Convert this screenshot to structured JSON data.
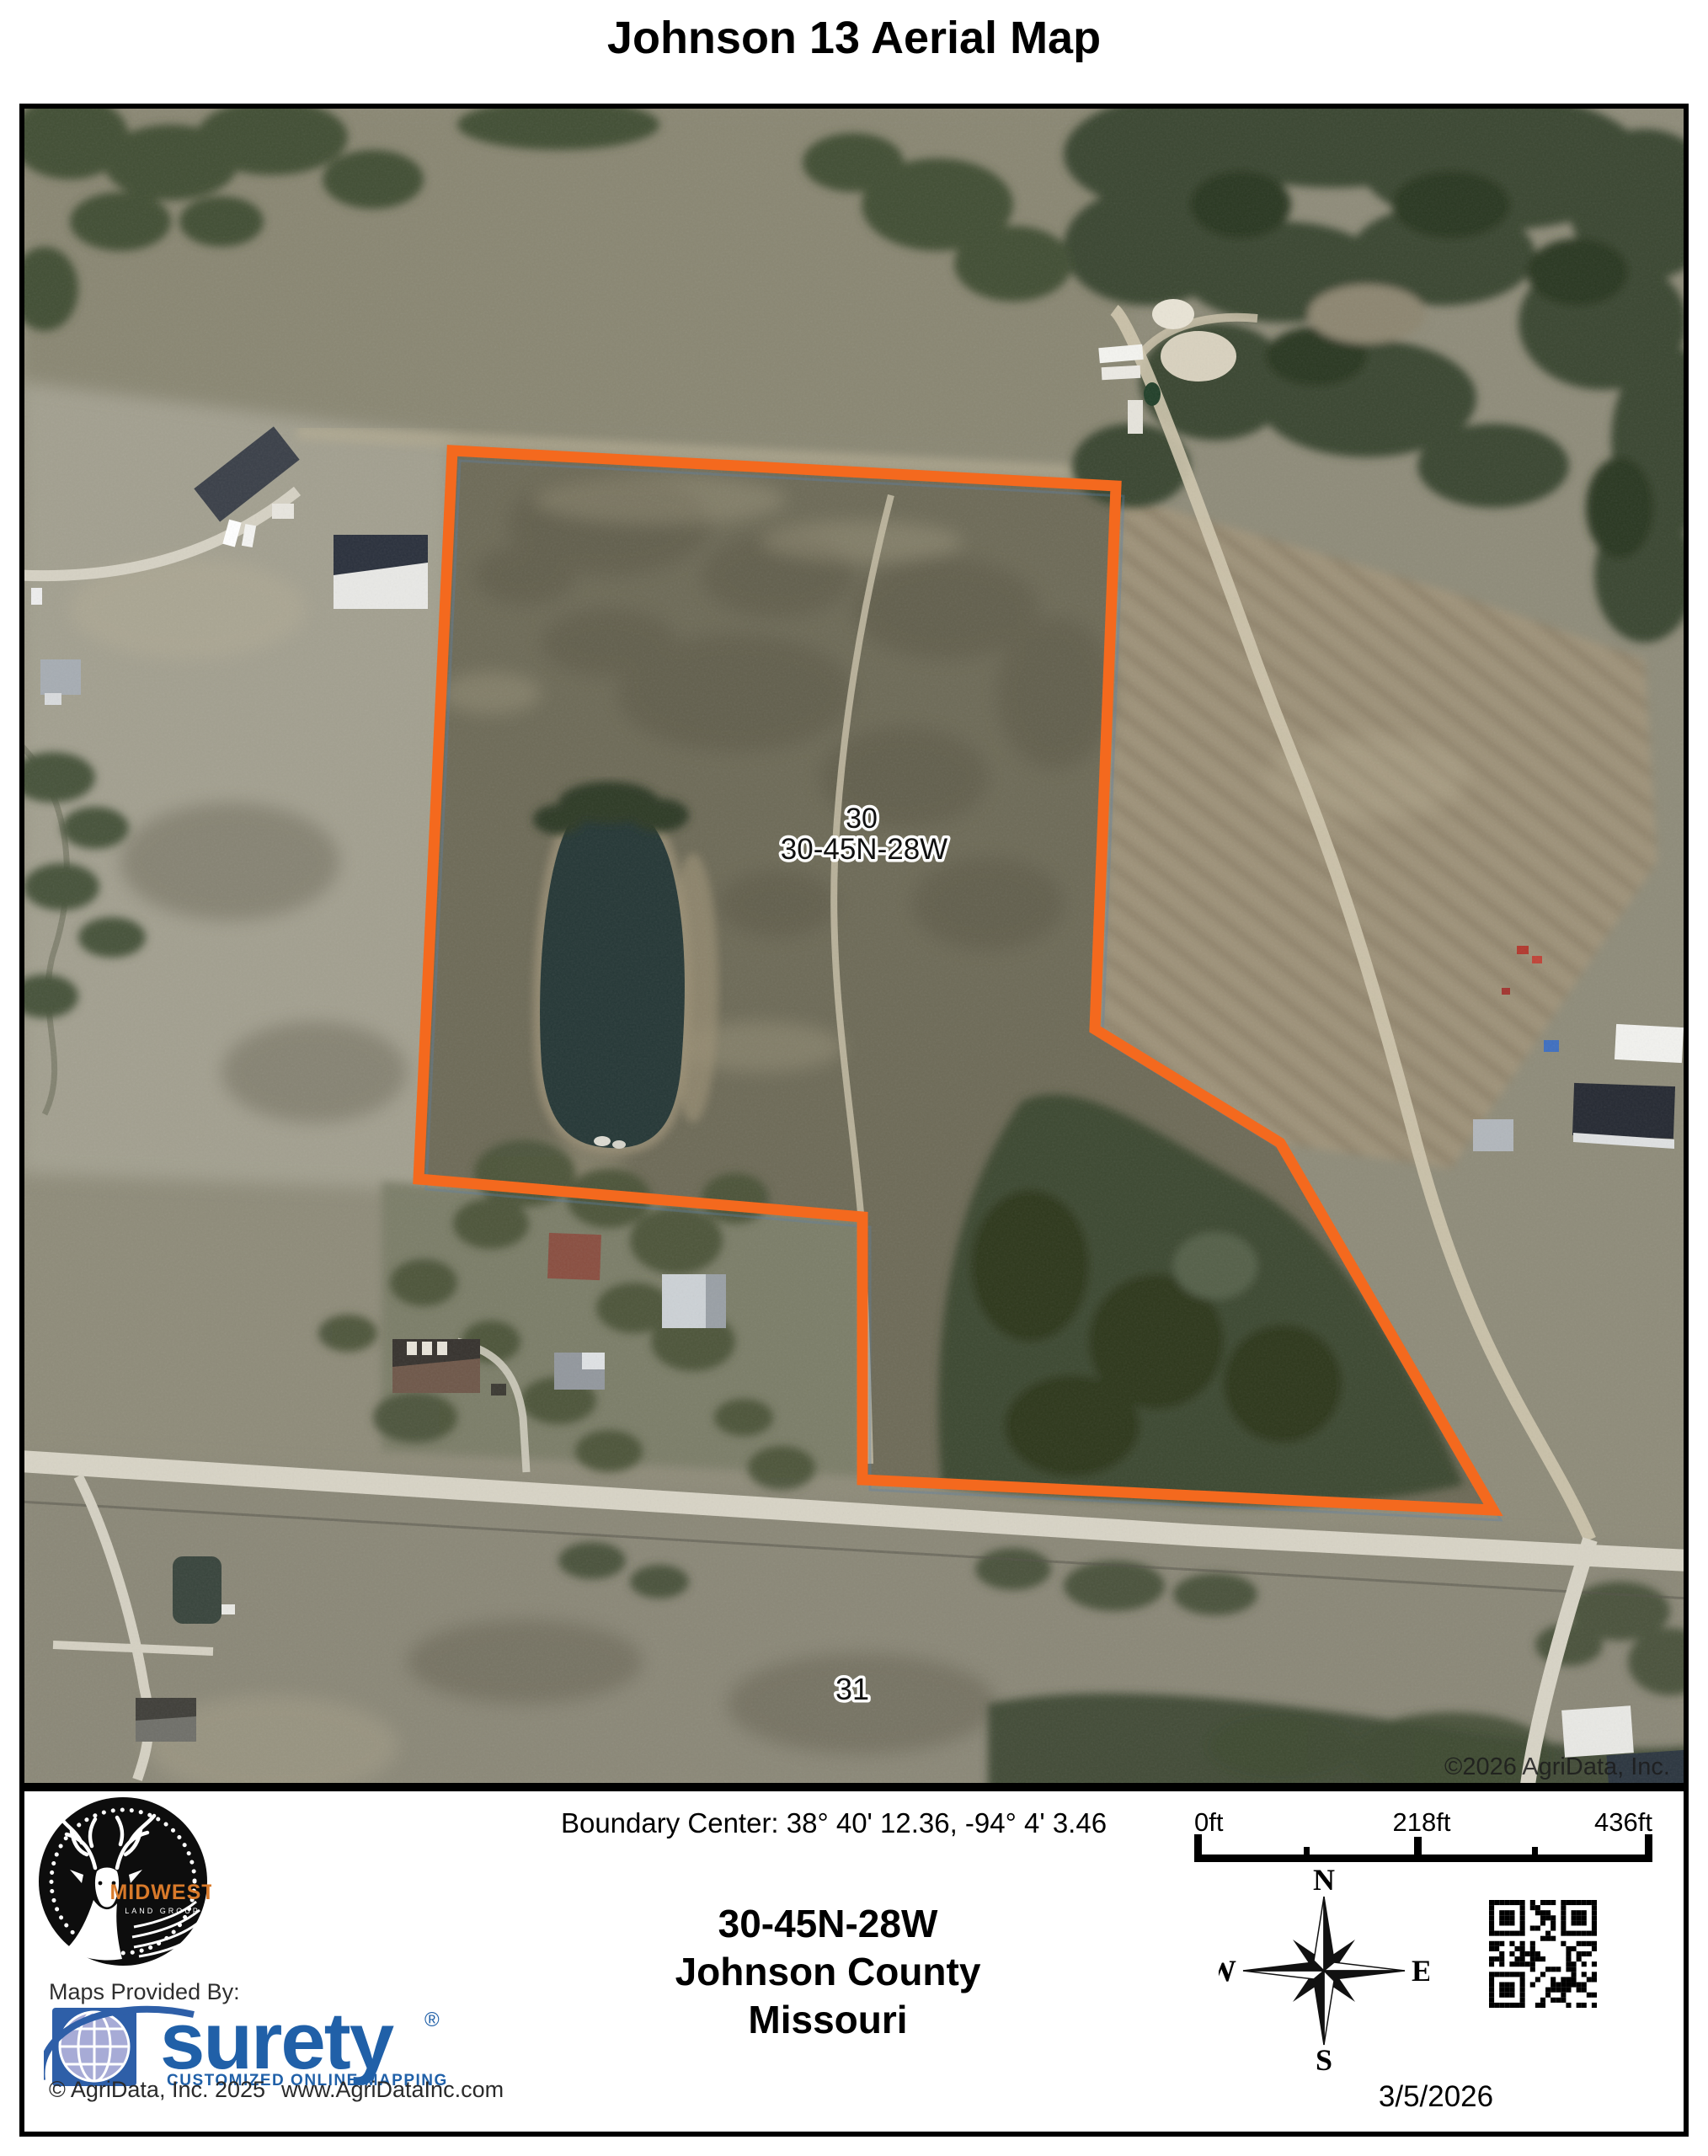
{
  "title": "Johnson 13 Aerial Map",
  "map": {
    "section_number": "30",
    "section_label": "30-45N-28W",
    "adjacent_section": "31",
    "imagery_credit": "©2026 AgriData, Inc.",
    "boundary_color": "#F4691E"
  },
  "footer": {
    "boundary_center": "Boundary Center: 38° 40' 12.36,  -94° 4' 3.46",
    "location": {
      "township": "30-45N-28W",
      "county": "Johnson County",
      "state": "Missouri"
    },
    "scale_bar": {
      "start": "0ft",
      "middle": "218ft",
      "end": "436ft"
    },
    "compass": {
      "north": "N",
      "east": "E",
      "south": "S",
      "west": "W"
    },
    "date": "3/5/2026",
    "provider": {
      "label": "Maps Provided By:",
      "brand": "surety",
      "registered": "®",
      "tagline": "CUSTOMIZED ONLINE MAPPING",
      "copyright": "© AgriData, Inc. 2025",
      "website": "www.AgriDataInc.com"
    },
    "logo": {
      "brand": "MIDWEST",
      "subtitle": "LAND GROUP"
    }
  }
}
